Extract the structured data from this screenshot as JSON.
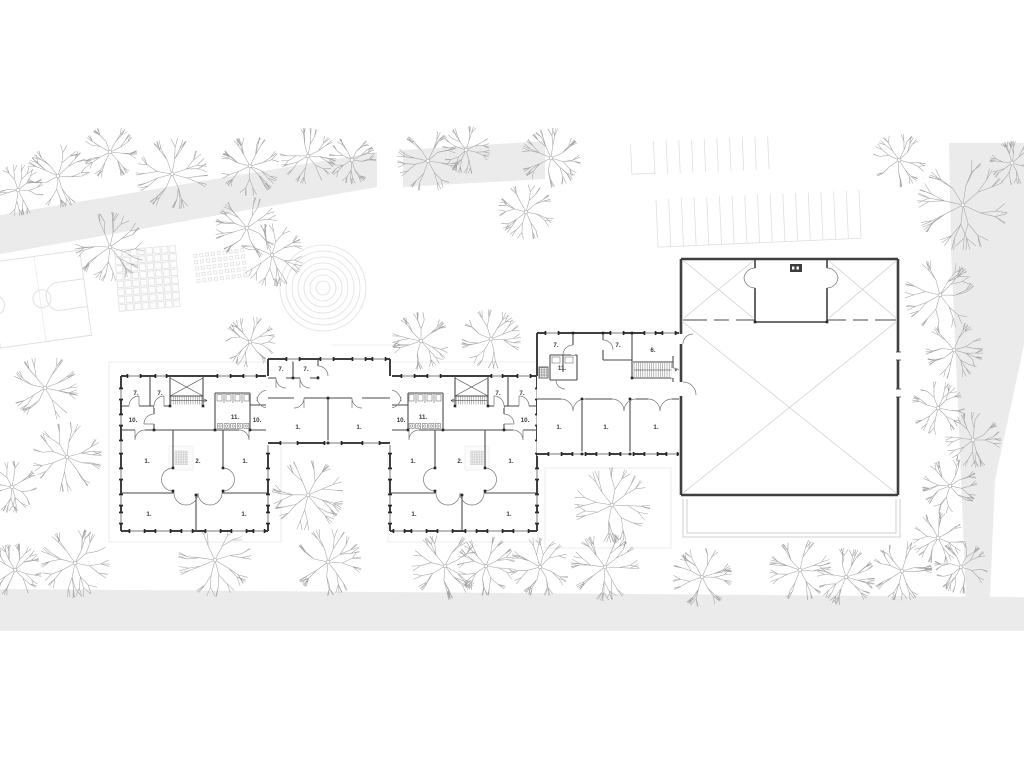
{
  "title": "Architectural site plan – ground floor",
  "colors": {
    "background": "#ffffff",
    "road": "#ebebeb",
    "wall": "#3f3f3f",
    "partition": "#4a4a4a",
    "door": "#757575",
    "xline": "#cccccc",
    "tree": "#a4a4a4",
    "label": "#3a3a3a",
    "hatch": "#6b6b6b",
    "light": "#dedede",
    "faint": "#e7e7e7",
    "terrace": "#cfcfcf",
    "column": "#262626",
    "fixture": "#3d3d3d"
  },
  "rooms": [
    {
      "label": "7.",
      "x": 136,
      "y": 395
    },
    {
      "label": "7.",
      "x": 160,
      "y": 395
    },
    {
      "label": "10.",
      "x": 133,
      "y": 422
    },
    {
      "label": "11.",
      "x": 235,
      "y": 419
    },
    {
      "label": "10.",
      "x": 257,
      "y": 422
    },
    {
      "label": "1.",
      "x": 147,
      "y": 463
    },
    {
      "label": "2.",
      "x": 198,
      "y": 463
    },
    {
      "label": "1.",
      "x": 245,
      "y": 463
    },
    {
      "label": "1.",
      "x": 149,
      "y": 516
    },
    {
      "label": "1.",
      "x": 244,
      "y": 516
    },
    {
      "label": "7.",
      "x": 522,
      "y": 395
    },
    {
      "label": "7.",
      "x": 498,
      "y": 395
    },
    {
      "label": "10.",
      "x": 525,
      "y": 422
    },
    {
      "label": "11.",
      "x": 423,
      "y": 419
    },
    {
      "label": "10.",
      "x": 401,
      "y": 422
    },
    {
      "label": "1.",
      "x": 511,
      "y": 463
    },
    {
      "label": "2.",
      "x": 460,
      "y": 463
    },
    {
      "label": "1.",
      "x": 413,
      "y": 463
    },
    {
      "label": "1.",
      "x": 509,
      "y": 516
    },
    {
      "label": "1.",
      "x": 414,
      "y": 516
    },
    {
      "label": "7.",
      "x": 281,
      "y": 371
    },
    {
      "label": "7.",
      "x": 306,
      "y": 371
    },
    {
      "label": "1.",
      "x": 298,
      "y": 429
    },
    {
      "label": "1.",
      "x": 359,
      "y": 429
    },
    {
      "label": "7.",
      "x": 556,
      "y": 347
    },
    {
      "label": "11.",
      "x": 562,
      "y": 370
    },
    {
      "label": "7.",
      "x": 618,
      "y": 347
    },
    {
      "label": "6.",
      "x": 653,
      "y": 352
    },
    {
      "label": "1.",
      "x": 559,
      "y": 429
    },
    {
      "label": "1.",
      "x": 606,
      "y": 429
    },
    {
      "label": "1.",
      "x": 656,
      "y": 429
    }
  ],
  "site": {
    "roads": {
      "upper_a": [
        [
          0,
          215
        ],
        [
          377,
          152
        ],
        [
          377,
          187
        ],
        [
          0,
          254
        ]
      ],
      "upper_b": [
        [
          403,
          150
        ],
        [
          545,
          141
        ],
        [
          545,
          179
        ],
        [
          403,
          187
        ]
      ],
      "right": [
        [
          949,
          143
        ],
        [
          1024,
          143
        ],
        [
          1024,
          345
        ],
        [
          995,
          480
        ],
        [
          990,
          597
        ],
        [
          966,
          597
        ],
        [
          959,
          430
        ],
        [
          951,
          250
        ]
      ],
      "bottom": [
        [
          0,
          589
        ],
        [
          1024,
          597
        ],
        [
          1024,
          631
        ],
        [
          0,
          631
        ]
      ]
    },
    "trees": [
      [
        18,
        190,
        26
      ],
      [
        58,
        176,
        32
      ],
      [
        110,
        152,
        27
      ],
      [
        172,
        174,
        36
      ],
      [
        250,
        166,
        30
      ],
      [
        308,
        156,
        28
      ],
      [
        352,
        160,
        24
      ],
      [
        428,
        161,
        31
      ],
      [
        466,
        150,
        24
      ],
      [
        551,
        158,
        30
      ],
      [
        526,
        212,
        28
      ],
      [
        110,
        247,
        35
      ],
      [
        247,
        228,
        32
      ],
      [
        272,
        255,
        32
      ],
      [
        899,
        160,
        27
      ],
      [
        963,
        205,
        46
      ],
      [
        1012,
        163,
        22
      ],
      [
        940,
        295,
        36
      ],
      [
        954,
        350,
        29
      ],
      [
        938,
        408,
        27
      ],
      [
        973,
        440,
        28
      ],
      [
        950,
        486,
        28
      ],
      [
        938,
        538,
        26
      ],
      [
        961,
        567,
        27
      ],
      [
        45,
        388,
        33
      ],
      [
        12,
        487,
        26
      ],
      [
        67,
        457,
        35
      ],
      [
        15,
        570,
        27
      ],
      [
        75,
        563,
        35
      ],
      [
        215,
        560,
        37
      ],
      [
        328,
        562,
        34
      ],
      [
        445,
        566,
        34
      ],
      [
        486,
        566,
        30
      ],
      [
        540,
        567,
        30
      ],
      [
        605,
        567,
        34
      ],
      [
        702,
        577,
        30
      ],
      [
        800,
        570,
        31
      ],
      [
        846,
        577,
        29
      ],
      [
        902,
        571,
        30
      ],
      [
        308,
        495,
        36
      ],
      [
        612,
        505,
        38
      ],
      [
        421,
        341,
        29
      ],
      [
        491,
        339,
        30
      ],
      [
        250,
        342,
        26
      ]
    ],
    "parking": {
      "angle": -2.5,
      "pivotx": 660,
      "pivoty": 200,
      "row1": {
        "x0": 656,
        "y0": 141,
        "len": 33,
        "count": 10,
        "step": 12.7
      },
      "row2": {
        "x0": 656,
        "y0": 199,
        "len": 48,
        "count": 17,
        "step": 12.7
      },
      "corner": [
        [
          633,
          143
        ],
        [
          633,
          173
        ],
        [
          657,
          173
        ]
      ]
    },
    "court": {
      "cx": 40,
      "cy": 299,
      "w": 92,
      "h": 86,
      "angle": -8
    },
    "paver_grid": {
      "cx": 148,
      "cy": 279,
      "cols": 8,
      "rows": 8,
      "cell": 7.8,
      "angle": -4.5
    },
    "dot_grid": {
      "cx": 222,
      "cy": 267,
      "cols": 9,
      "rows": 5,
      "sx": 5.9,
      "sy": 6.3,
      "size": 3,
      "angle": -7
    },
    "rings": {
      "cx": 323,
      "cy": 288,
      "count": 7,
      "r0": 7,
      "dr": 6
    },
    "terrace": {
      "x": 683,
      "y": 499,
      "w": 217,
      "h": 38,
      "inset": 4
    },
    "faint_rects": [
      [
        109,
        362,
        172,
        180
      ],
      [
        388,
        362,
        150,
        180
      ],
      [
        545,
        468,
        126,
        80
      ]
    ],
    "canopy_line": [
      [
        332,
        345
      ],
      [
        402,
        345
      ]
    ]
  },
  "building": {
    "stage_fixture": {
      "x": 790,
      "y": 264,
      "w": 12,
      "h": 8
    }
  }
}
